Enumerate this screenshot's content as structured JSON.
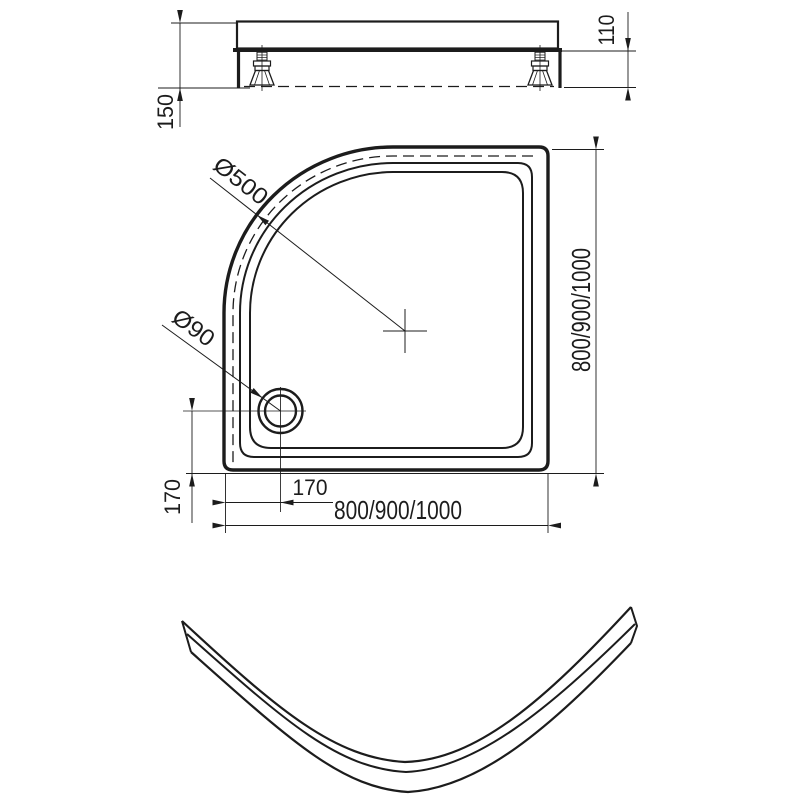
{
  "drawing": {
    "title": "quadrant-shower-tray-technical-drawing",
    "background": "#ffffff",
    "line_color": "#1c1c1c",
    "labels": {
      "side_view": {
        "total_height": "150",
        "tray_height": "110"
      },
      "plan_view": {
        "corner_radius": "Ø500",
        "drain_diameter": "Ø90",
        "depth_options": "800/900/1000",
        "width_options": "800/900/1000",
        "drain_offset_horizontal": "170",
        "drain_offset_vertical": "170"
      }
    }
  }
}
